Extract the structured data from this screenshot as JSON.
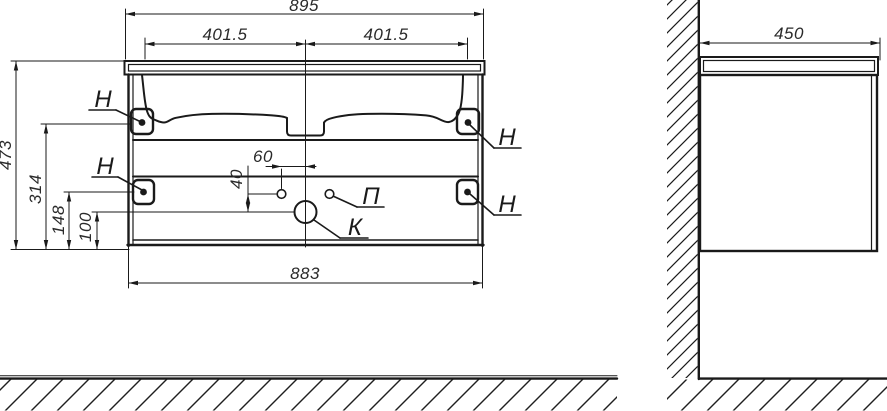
{
  "front_view": {
    "dims": {
      "overall_width": "895",
      "left_half": "401.5",
      "right_half": "401.5",
      "total_height": "473",
      "upper_hanger_height": "314",
      "lower_hanger_height": "148",
      "drain_height": "100",
      "supply_offset": "60",
      "supply_drop": "40",
      "body_width": "883"
    },
    "labels": {
      "hanger": "Н",
      "supply": "П",
      "drain": "К"
    }
  },
  "side_view": {
    "dims": {
      "depth": "450"
    }
  },
  "colors": {
    "line": "#1a1a1a",
    "background": "#ffffff"
  }
}
